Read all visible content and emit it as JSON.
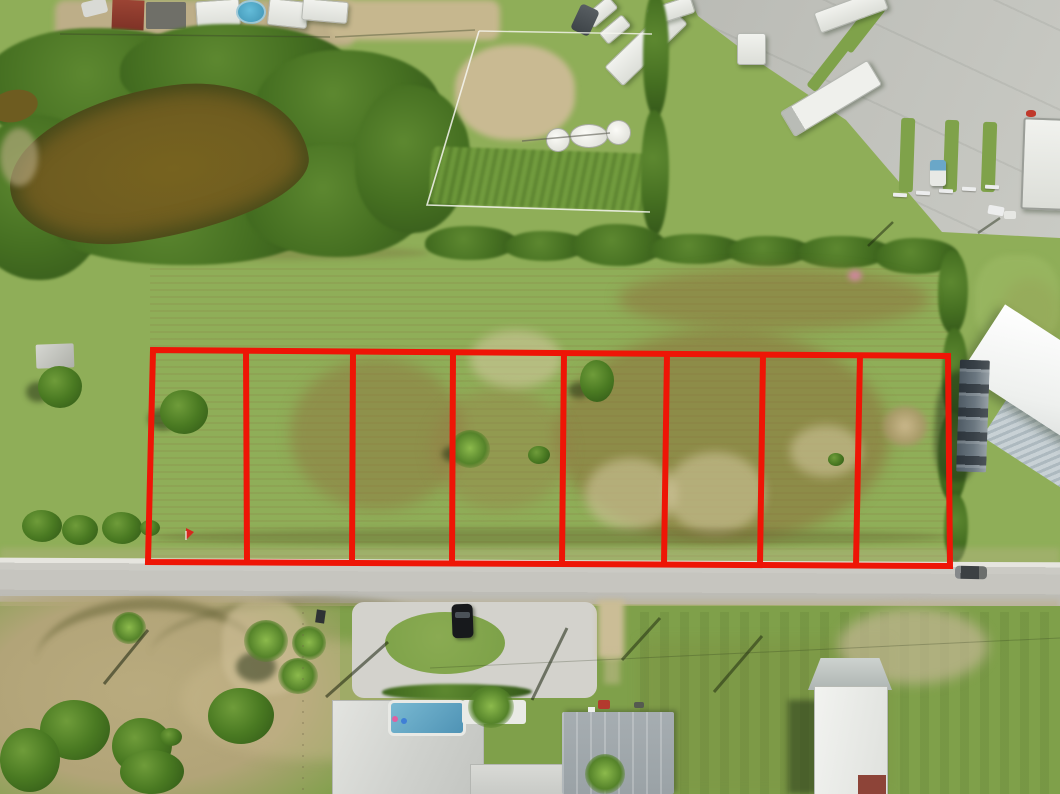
{
  "scene": {
    "type": "aerial-drone-photograph",
    "subject": "Eight contiguous vacant land lots outlined in red along a rural residential road, with a pond, RV storage yard and houses",
    "overlay": {
      "lot_count": 8,
      "boundary_color": "#ee1506",
      "stroke_width": 6,
      "polygon_points": "153,350 948,356 950,566 148,562",
      "dividers": [
        {
          "x1": 246,
          "y1": 351,
          "x2": 247,
          "y2": 562
        },
        {
          "x1": 353,
          "y1": 352,
          "x2": 352,
          "y2": 562
        },
        {
          "x1": 453,
          "y1": 352,
          "x2": 452,
          "y2": 563
        },
        {
          "x1": 564,
          "y1": 353,
          "x2": 562,
          "y2": 563
        },
        {
          "x1": 667,
          "y1": 354,
          "x2": 664,
          "y2": 564
        },
        {
          "x1": 763,
          "y1": 354,
          "x2": 760,
          "y2": 564
        },
        {
          "x1": 860,
          "y1": 355,
          "x2": 856,
          "y2": 565
        }
      ]
    },
    "palette": {
      "field_green": "#8fae58",
      "lawn_green": "#7fa04a",
      "vegetation_dark": "#3f671f",
      "pond_water": "#6e5c20",
      "road_asphalt": "#c6c5bf",
      "concrete": "#bfc0ba",
      "sand": "#c6b78e",
      "roof_white": "#f2f3f0",
      "roof_gray": "#9aa2a6",
      "roof_red": "#8d4438"
    },
    "features": [
      {
        "name": "pond",
        "label": "brown pond ringed by dense brush"
      },
      {
        "name": "rv-storage-yard",
        "label": "concrete pad with parked RVs and trailers"
      },
      {
        "name": "fenced-paddock",
        "label": "fenced paddock with white septic tanks"
      },
      {
        "name": "outlined-lots",
        "label": "eight vacant lots outlined in red"
      },
      {
        "name": "road",
        "label": "gray paved road below the lots"
      },
      {
        "name": "residences",
        "label": "houses, driveways, pool and palm trees along the road"
      }
    ]
  }
}
